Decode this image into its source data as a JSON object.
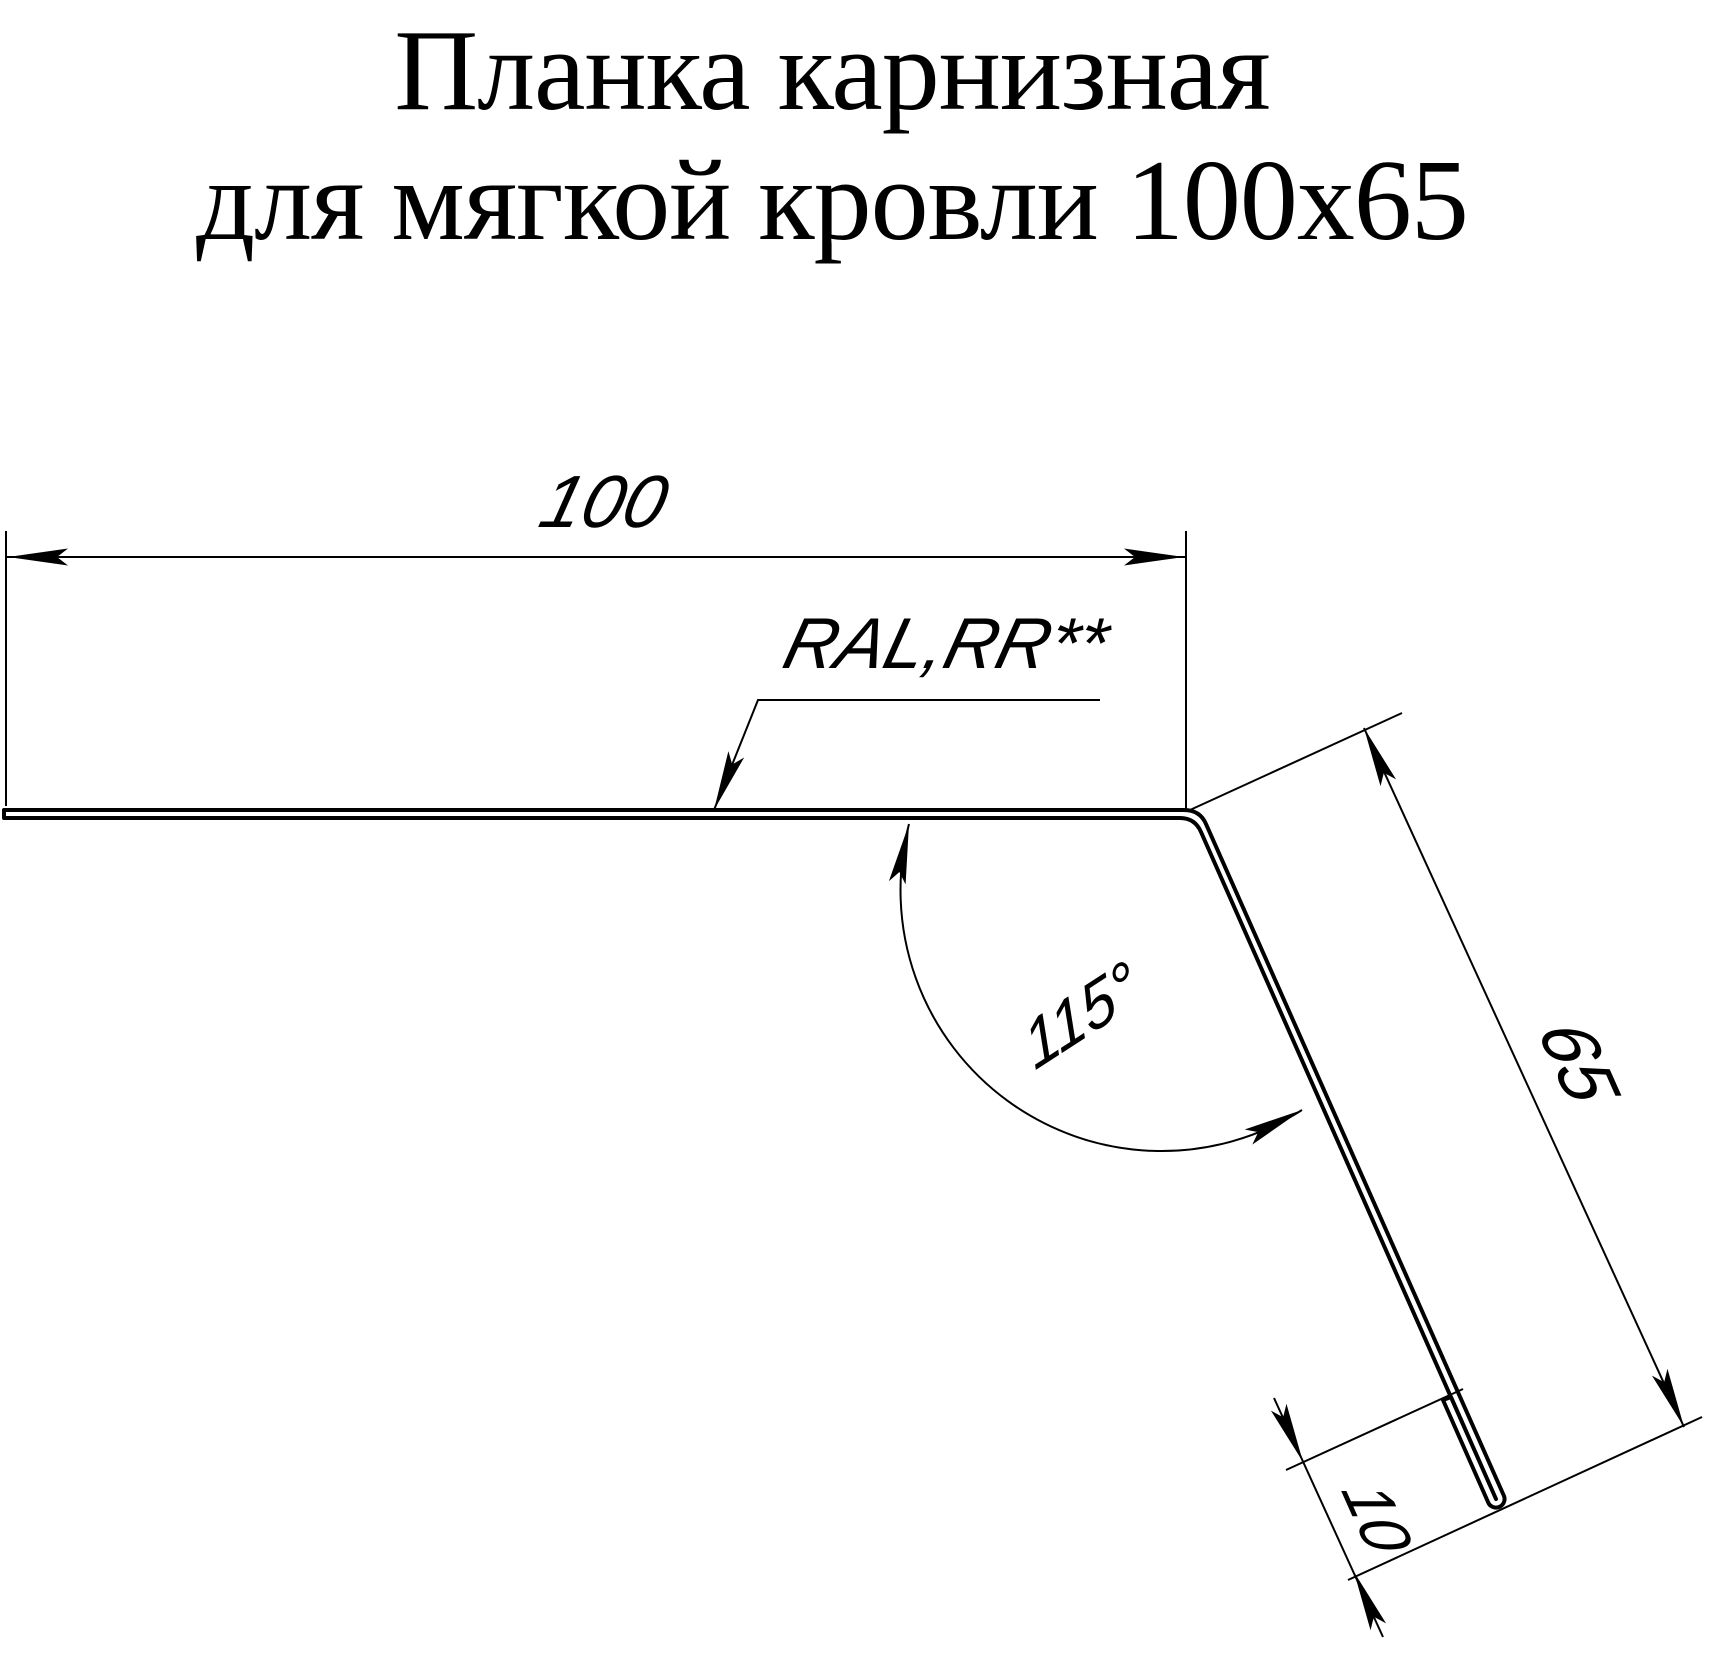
{
  "title": {
    "line1": "Планка карнизная",
    "line2": "для мягкой кровли 100x65"
  },
  "annotations": {
    "dim_top_width": "100",
    "dim_side_length": "65",
    "dim_hem_length": "10",
    "dim_bend_angle": "115°",
    "coating_note": "RAL,RR**"
  },
  "colors": {
    "ink": "#000000",
    "paper": "#ffffff"
  }
}
